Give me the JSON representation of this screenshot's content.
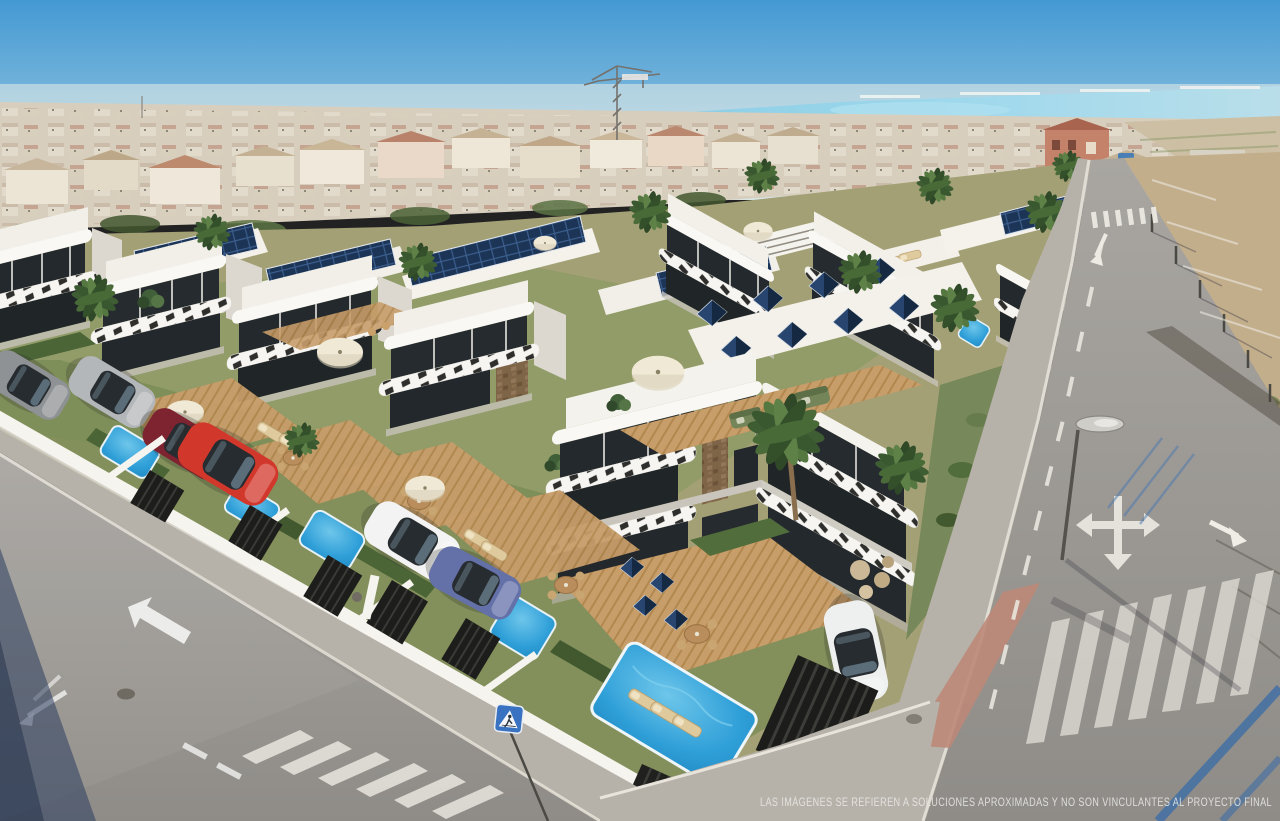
{
  "scene": {
    "kind_label": "aerial-render-villa-development",
    "disclaimer": "LAS IMÁGENES SE REFIEREN A SOLUCIONES APROXIMADAS Y NO SON VINCULANTES AL PROYECTO FINAL"
  },
  "palette": {
    "sky_top": "#4499d4",
    "sky_horizon": "#d8e6e8",
    "sea_lagoon": "#8ecfe6",
    "distant_town": "#d7cebd",
    "road_asphalt": "#9b9894",
    "sidewalk": "#b7b2a9",
    "villa_white": "#f8f7f3",
    "villa_shadow_face": "#dcd8d0",
    "glass_dark": "#24292d",
    "solar_panel": "#1c3456",
    "solar_grid_line": "#3c5f8e",
    "pool_water": "#2f9fd8",
    "deck_wood": "#c79d6a",
    "grass": "#7a8c55",
    "hedge": "#4b6537",
    "dirt_field": "#c3ae8c",
    "boundary_wall": "#f6f4ee",
    "gate_dark": "#1d1d1b",
    "car_red": "#d2372b",
    "car_maroon": "#7e2330",
    "car_blue": "#6470a8",
    "car_silver": "#b4b7b9",
    "car_white": "#f2f3f2",
    "sign_blue": "#3a72c2",
    "road_marking": "#efede5",
    "shadow_blue": "#2c3e5e"
  }
}
